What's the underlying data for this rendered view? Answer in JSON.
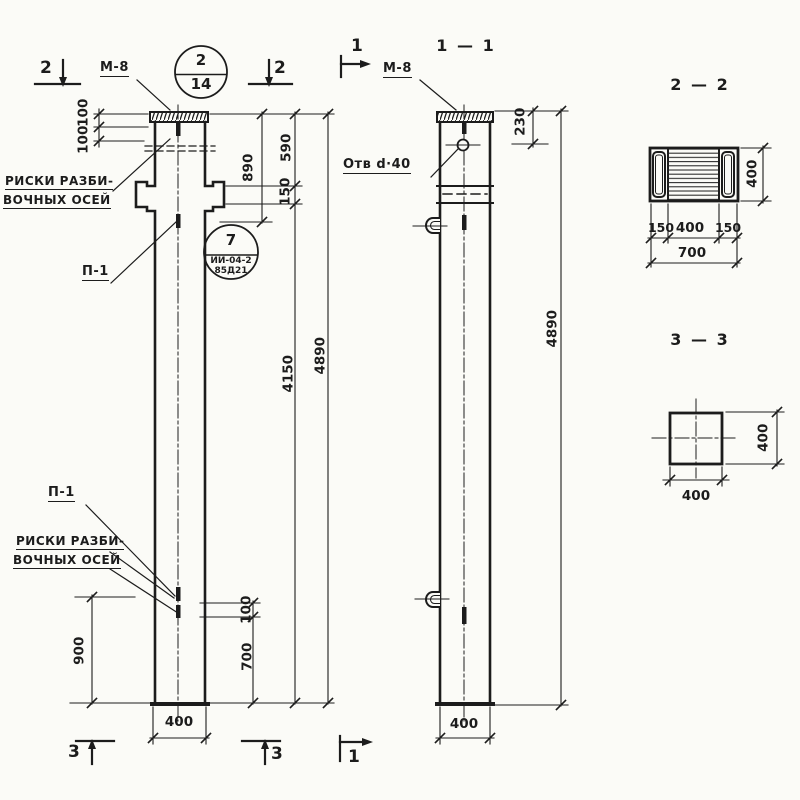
{
  "colors": {
    "ink": "#1c1c1c",
    "paper": "#fbfbf7"
  },
  "front": {
    "mark_top_left": "2",
    "mark_top_right": "2",
    "mark_bottom_left": "3",
    "mark_bottom_right": "3",
    "m8": "М-8",
    "p1_top": "П-1",
    "p1_bottom": "П-1",
    "risks_top_line1": "РИСКИ РАЗБИ-",
    "risks_top_line2": "ВОЧНЫХ ОСЕЙ",
    "risks_bottom_line1": "РИСКИ РАЗБИ-",
    "risks_bottom_line2": "ВОЧНЫХ ОСЕЙ",
    "dim_100a": "100",
    "dim_100b": "100",
    "dim_890": "890",
    "dim_590": "590",
    "dim_150": "150",
    "dim_4150": "4150",
    "dim_4890": "4890",
    "dim_900": "900",
    "dim_100c": "100",
    "dim_700": "700",
    "dim_400": "400",
    "stamp_num": "2",
    "stamp_den": "14",
    "ref_num": "7",
    "ref_series": "ИИ-04-2",
    "ref_sheet": "85Д21"
  },
  "sec11": {
    "title": "1 — 1",
    "mark_top": "1",
    "mark_bottom": "1",
    "m8": "М-8",
    "hole": "Отв d·40",
    "dim_230": "230",
    "dim_4890": "4890",
    "dim_400": "400"
  },
  "sec22": {
    "title": "2 — 2",
    "dim_400r": "400",
    "dim_150a": "150",
    "dim_400b": "400",
    "dim_150b": "150",
    "dim_700": "700"
  },
  "sec33": {
    "title": "3 — 3",
    "dim_400r": "400",
    "dim_400b": "400"
  }
}
